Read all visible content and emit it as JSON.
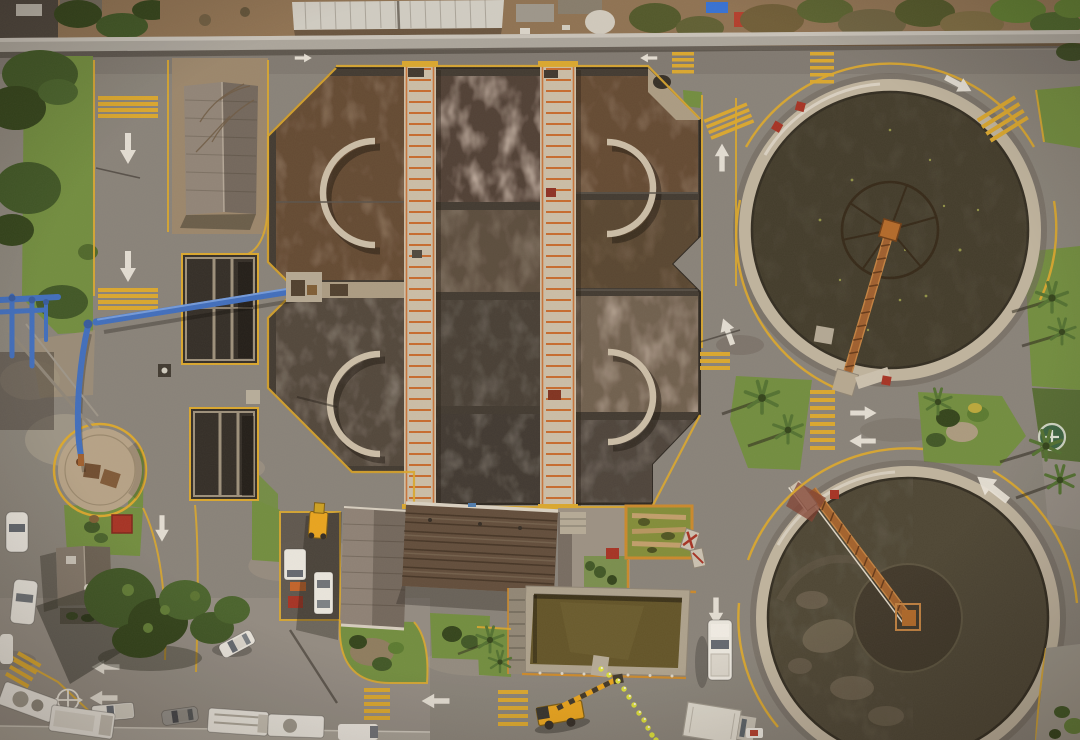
{
  "meta": {
    "type": "aerial-photograph",
    "subject": "wastewater treatment plant",
    "view": "top-down drone view, daytime, hard sunlight from upper right"
  },
  "palette": {
    "asphalt": "#85817a",
    "asphalt-light": "#97928a",
    "asphalt-dark": "#6f6b65",
    "dirt": "#8b7052",
    "dirt-pad": "#97856c",
    "sand": "#b3a288",
    "wall": "#a8a59e",
    "wall-cap": "#c6c3bc",
    "concrete": "#c9bea9",
    "concrete-dim": "#a89b84",
    "grass": "#6d8c3e",
    "grass-dark": "#4a6629",
    "tree": "#3a5424",
    "tree-dark": "#2c4019",
    "palm": "#4e7030",
    "water-brown": "#5e4631",
    "water-tan": "#7a695a",
    "water-dark": "#413b34",
    "water-gray": "#4c433a",
    "clar-north-water": "#3c3829",
    "clar-south-water": "#474233",
    "scum": "#6b6150",
    "ring": "#bdb3a0",
    "wheel": "#2e2416",
    "rust": "#9c5c2c",
    "rust-light": "#c08040",
    "hub-orange": "#b06828",
    "yellow": "#d9a72c",
    "rail-orange": "#c45f1e",
    "pipe-orange": "#c8882a",
    "red": "#a32e22",
    "blue": "#3a6cc0",
    "blue-light": "#6f9ade",
    "white-paint": "#e9e6dd",
    "vehicle": "#e9e7e1",
    "vehicle-gray": "#85878b",
    "crane": "#e8a41c",
    "hivis": "#d8de38",
    "roof-brown": "#5c4a3a",
    "roof-gray": "#7e7263",
    "roof-white": "#cfcdc6",
    "roof-house": "#8a8076",
    "pond": "#7e8c38",
    "olive": "#5d5126"
  },
  "scene": {
    "clarifiers": [
      {
        "id": "north",
        "center": [
          890,
          230
        ],
        "water_radius": 138,
        "has_center_wheel": true,
        "bridge": "rusted radial bridge pointing south"
      },
      {
        "id": "south",
        "center": [
          908,
          618
        ],
        "water_radius": 140,
        "has_center_pier": true,
        "bridge": "rusted truss bridge from northwest rim"
      }
    ],
    "aeration_basin": {
      "shape": "chamfered octagonal complex",
      "walkways": 2,
      "cells": 9,
      "curved_baffles": 4,
      "railing_color": "orange"
    },
    "grit_tanks": 2,
    "sludge_pipe": {
      "color": "blue",
      "route": "from basin west edge across road to circular drying pad"
    },
    "buildings": {
      "workshop_roofs": 2,
      "small_houses": 2,
      "white_roof_offsite": 1
    },
    "ponds": {
      "algae_pond": 1,
      "rect_storage_tank": 1,
      "circular_drying_pad": 1
    },
    "markings": {
      "white_arrows": 15,
      "crosswalks": 9,
      "mini_roundabout_symbol": 1,
      "green_circle_symbol": 1,
      "red_marker_pads": 6
    },
    "vegetation": {
      "palm_trees": 9,
      "broadleaf_trees": 7,
      "grass_islands": 8
    },
    "vehicles": {
      "white_cars": 7,
      "white_trucks": 6,
      "white_pickups": 2,
      "gray_cars": 2,
      "yellow_machines": 2
    },
    "workers": {
      "count": 11,
      "vest_color": "hi-vis yellow"
    }
  }
}
